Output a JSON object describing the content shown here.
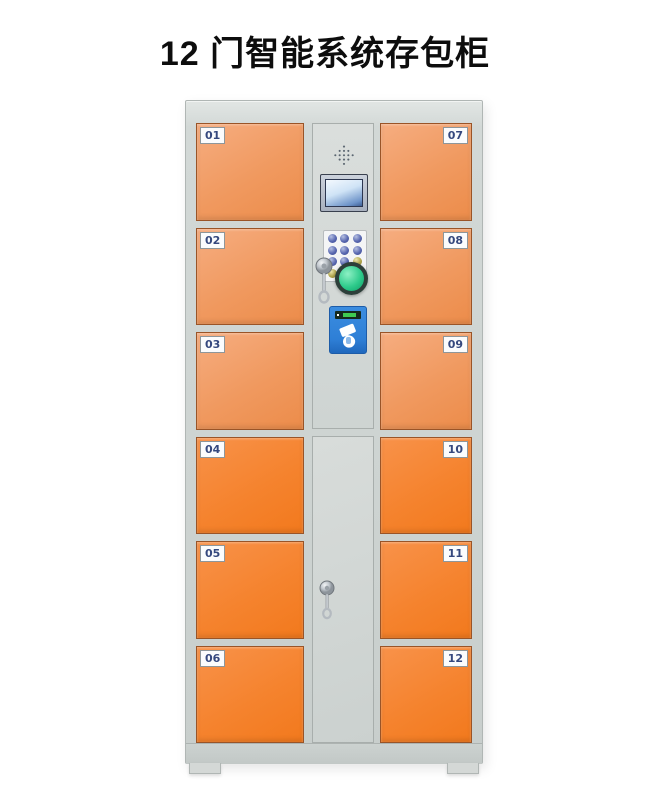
{
  "title": "12 门智能系统存包柜",
  "locker": {
    "left_doors": [
      {
        "label": "01"
      },
      {
        "label": "02"
      },
      {
        "label": "03"
      },
      {
        "label": "04"
      },
      {
        "label": "05"
      },
      {
        "label": "06"
      }
    ],
    "right_doors": [
      {
        "label": "07"
      },
      {
        "label": "08"
      },
      {
        "label": "09"
      },
      {
        "label": "10"
      },
      {
        "label": "11"
      },
      {
        "label": "12"
      }
    ],
    "panel": {
      "components": [
        "speaker-grill",
        "lcd-display",
        "numeric-keypad",
        "key-lock",
        "green-confirm-button",
        "card-reader"
      ]
    }
  },
  "colors": {
    "door_light": "#f0995f",
    "door_light_hi": "#f6ad80",
    "door_bright": "#f5832e",
    "door_bright_hi": "#f8924a",
    "cabinet_gray": "#cdd3d1",
    "button_green": "#2fcb8c",
    "reader_blue": "#2e7fd6",
    "label_text": "#35487e"
  }
}
